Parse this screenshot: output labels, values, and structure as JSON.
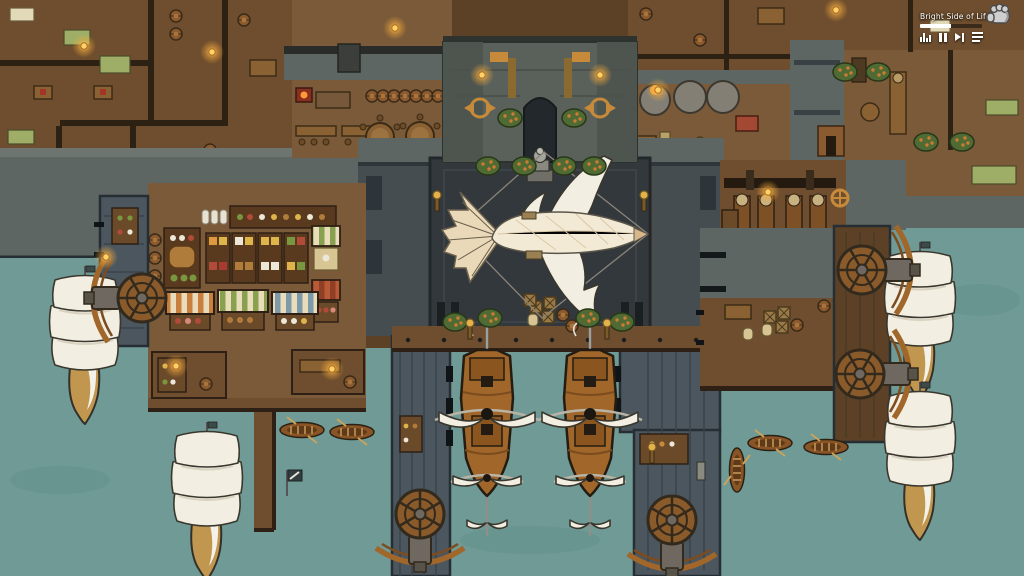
{
  "app": {
    "type": "city-builder-game",
    "view": "harbor-town-overhead"
  },
  "music_player": {
    "title": "Bright Side of Life",
    "progress_percent": 50,
    "controls": [
      {
        "name": "equalizer-icon"
      },
      {
        "name": "pause-button"
      },
      {
        "name": "next-track-button"
      },
      {
        "name": "playlist-button"
      }
    ]
  },
  "cursor": {
    "name": "hand-cursor"
  },
  "scene": {
    "entities": {
      "airship": 1,
      "white_sail_ships": 4,
      "docked_cargo_ships": 2,
      "rowboats": 5,
      "treadwheel_cranes": 5,
      "market_stalls": 6,
      "kilns": 3
    }
  },
  "palette": {
    "water": "#6f9a95",
    "water_deep": "#64908b",
    "wood_floor": "#6e4e2e",
    "wood_floor_light": "#7a5a38",
    "wood_floor_dark": "#5c4126",
    "wood_wall": "#2d2114",
    "stone_light": "#828783",
    "stone_mid": "#5d6663",
    "stone_dark": "#3a4145",
    "pier_stone": "#4b565e",
    "pier_edge": "#262e34",
    "plaza": "#33383c",
    "gate_stone": "#5a615a",
    "sail_white": "#f2eee2",
    "sail_shadow": "#d9d2c0",
    "hull_tan": "#c1964f",
    "ship_brown": "#a0662a",
    "awning_orange": "#c9803f",
    "awning_green": "#87a14f",
    "awning_blue": "#7e99a8",
    "awning_red": "#b85a36",
    "awning_cream": "#e9dcba",
    "produce_red": "#b14a38",
    "produce_yellow": "#ddb54b",
    "produce_white": "#ece7d6",
    "produce_green": "#79973f",
    "bread_brown": "#b07c3c",
    "lamp_glow": "#f5a93c",
    "bush_green": "#4f6b33",
    "bush_orange": "#cd7a33",
    "gold": "#c78a3a",
    "metal_gray": "#6e6860"
  }
}
